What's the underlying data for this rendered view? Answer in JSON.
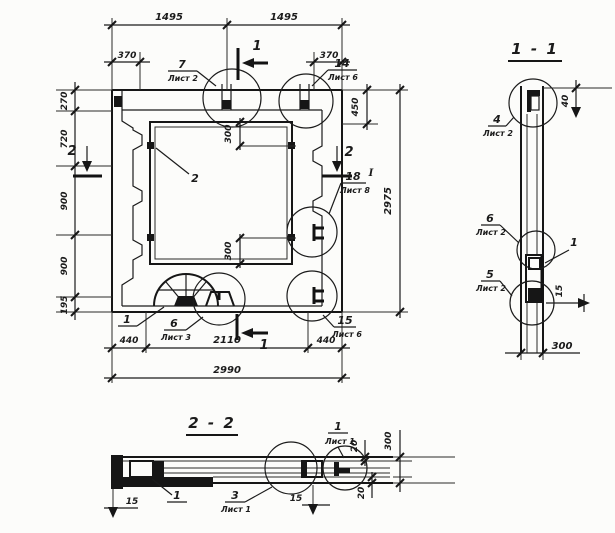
{
  "plan": {
    "dims": {
      "w_half_left": "1495",
      "w_half_right": "1495",
      "offset_left": "370",
      "offset_right": "370",
      "h_270": "270",
      "h_720": "720",
      "h_900_a": "900",
      "h_900_b": "900",
      "h_195": "195",
      "v_450": "450",
      "total_h": "2975",
      "open_300_top": "300",
      "open_300_bottom": "300",
      "b_440_left": "440",
      "b_2110": "2110",
      "b_440_right": "440",
      "total_w": "2990"
    },
    "marks": {
      "section1_top": "1",
      "section1_bottom": "1",
      "section2_left": "2",
      "section2_right": "2"
    },
    "callouts": {
      "c7": {
        "num": "7",
        "sheet": "Лист 2"
      },
      "c14": {
        "num": "14",
        "sheet": "Лист 6"
      },
      "c2": {
        "num": "2"
      },
      "c18": {
        "num": "18",
        "sheet": "Лист 8",
        "mark": "I"
      },
      "c1": {
        "num": "1"
      },
      "c6": {
        "num": "6",
        "sheet": "Лист 3"
      },
      "c15": {
        "num": "15",
        "sheet": "Лист 6"
      }
    }
  },
  "section_1_1": {
    "title": "1 - 1",
    "dims": {
      "d40": "40",
      "d15": "15",
      "d300": "300"
    },
    "callouts": {
      "c4": {
        "num": "4",
        "sheet": "Лист 2"
      },
      "c6": {
        "num": "6",
        "sheet": "Лист 2"
      },
      "c5": {
        "num": "5",
        "sheet": "Лист 2"
      },
      "c1": {
        "num": "1"
      }
    }
  },
  "section_2_2": {
    "title": "2 - 2",
    "dims": {
      "d15_left": "15",
      "d15_right": "15",
      "d20_top": "20",
      "d20_bottom": "20",
      "d300": "300"
    },
    "callouts": {
      "c1": {
        "num": "1"
      },
      "c3": {
        "num": "3",
        "sheet": "Лист 1"
      },
      "c1b": {
        "num": "1",
        "sheet": "Лист 1"
      }
    }
  }
}
